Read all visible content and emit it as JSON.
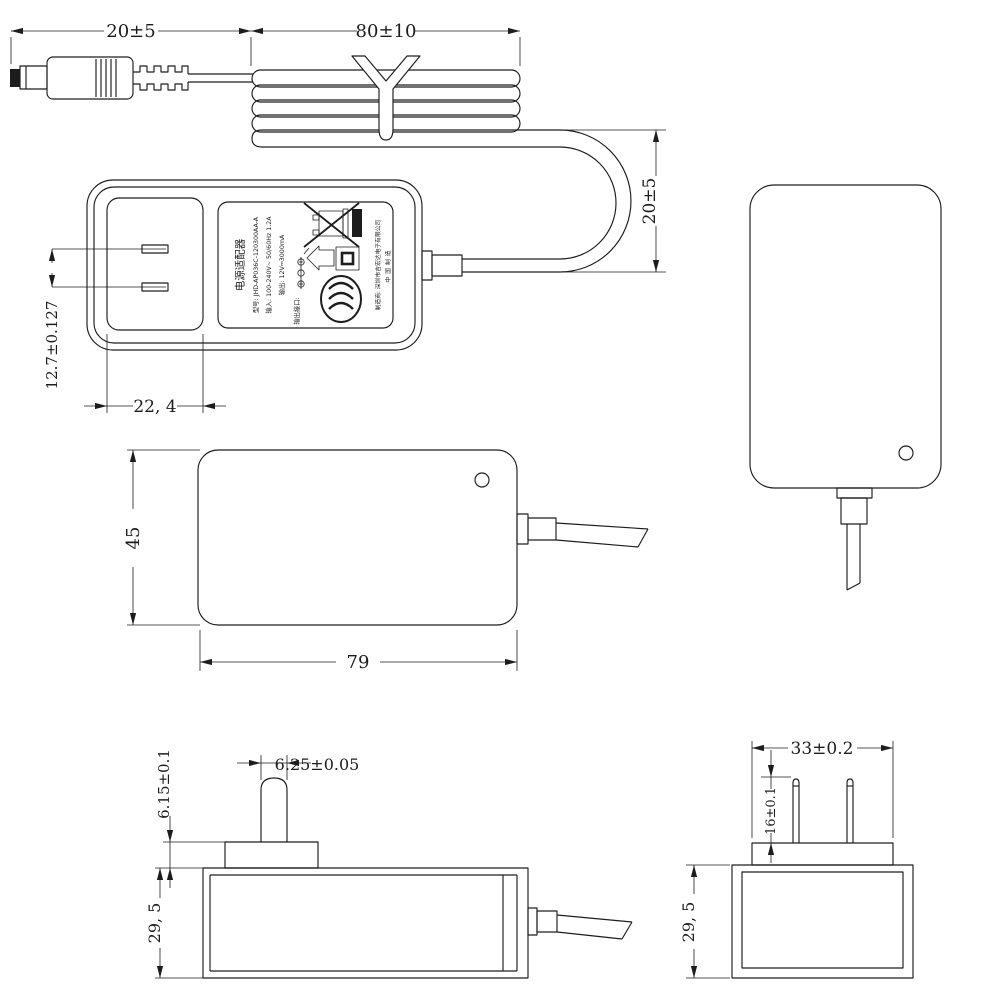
{
  "drawing": {
    "title": "AC power adapter dimensional drawing",
    "units": "mm",
    "views": [
      "cable-assembly",
      "front-view",
      "back-view",
      "rear-profile-view",
      "bottom-profile-view",
      "end-view"
    ]
  },
  "cable_assembly": {
    "dim_plug_length": "20±5",
    "dim_coil_length": "80±10",
    "dim_loop_drop": "20±5"
  },
  "front_view": {
    "dim_pin_pitch": "12.7±0.127",
    "dim_pin_area_width": "22, 4",
    "label": {
      "title": "电源适配器",
      "model": "型号: JHD-AP036C-120300AA-A",
      "input": "输入: 100-240V~ 50/60Hz 1.2A",
      "output": "输出: 12V⎓3000mA",
      "output_port": "输出接口:",
      "manufacturer": "制造商: 深圳市吉宏达电子有限公司",
      "made_in": "中国制造",
      "icons": [
        "weee-crossed-bin",
        "black-bar",
        "indoor-use-house",
        "class-ii-double-square",
        "ccc-certification",
        "polarity-center-positive"
      ]
    }
  },
  "back_view": {
    "dim_height": "45",
    "dim_length": "79"
  },
  "side_view": {
    "dim_pin_width": "6.25±0.05",
    "dim_base_height": "6.15±0.1",
    "dim_body_height": "29, 5"
  },
  "end_view": {
    "dim_base_width": "33±0.2",
    "dim_pin_length": "16±0.1",
    "dim_body_height": "29, 5"
  },
  "colors": {
    "line": "#1d1d1d",
    "background": "#ffffff"
  }
}
